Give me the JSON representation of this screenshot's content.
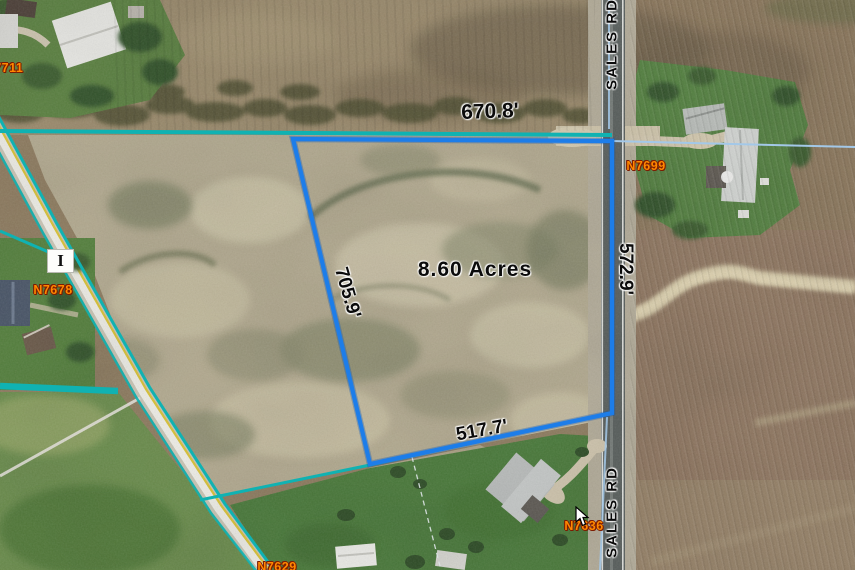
{
  "map": {
    "type": "aerial-parcel-view",
    "parcel": {
      "area_label": "8.60 Acres",
      "dimensions": {
        "north": "670.8'",
        "west": "705.9'",
        "east": "572.9'",
        "south": "517.7'"
      },
      "outline_color": "#1d7de9"
    },
    "road_labels": {
      "sales_rd_north": "SALES RD",
      "sales_rd_south": "SALES RD"
    },
    "address_labels": {
      "n7711": "N7711",
      "n7699": "N7699",
      "n7678": "N7678",
      "n7636": "N7636",
      "n7629": "N7629"
    },
    "section_marker": "I",
    "icons": {
      "cursor": "mouse-pointer-icon",
      "section_marker": "section-marker-box-icon"
    },
    "colors": {
      "parcel_outline_blue": "#1d7de9",
      "boundary_teal": "#10b2b2",
      "boundary_light_blue": "#a3c8e8",
      "address_text_orange": "#ff8800",
      "dimension_text": "#0b0b0b",
      "road_stripe_yellow": "#d9c235"
    }
  }
}
